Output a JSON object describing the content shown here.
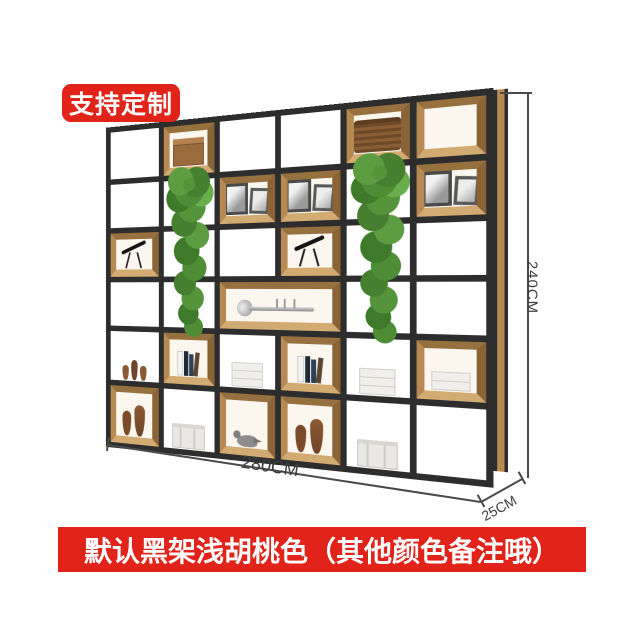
{
  "badge": {
    "label": "支持定制",
    "bg_color": "#e2231a",
    "text_color": "#ffffff"
  },
  "banner": {
    "label": "默认黑架浅胡桃色（其他颜色备注哦）",
    "bg_color": "#e2231a",
    "text_color": "#ffffff"
  },
  "dimensions": {
    "height_label": "240CM",
    "width_label": "280CM",
    "depth_label": "25CM"
  },
  "shelf": {
    "frame_color": "#2d2d2d",
    "wood_color": "#c9a36b",
    "backing_color": "#ffffff",
    "decor_items": [
      "cardboard-box",
      "wicker-basket",
      "picture-frames",
      "hanging-plant",
      "telescope",
      "trumpet",
      "white-vase",
      "books",
      "paper-stack",
      "ceramic-vases",
      "small-vases",
      "pigeon-figurine",
      "metal-trunk"
    ]
  }
}
